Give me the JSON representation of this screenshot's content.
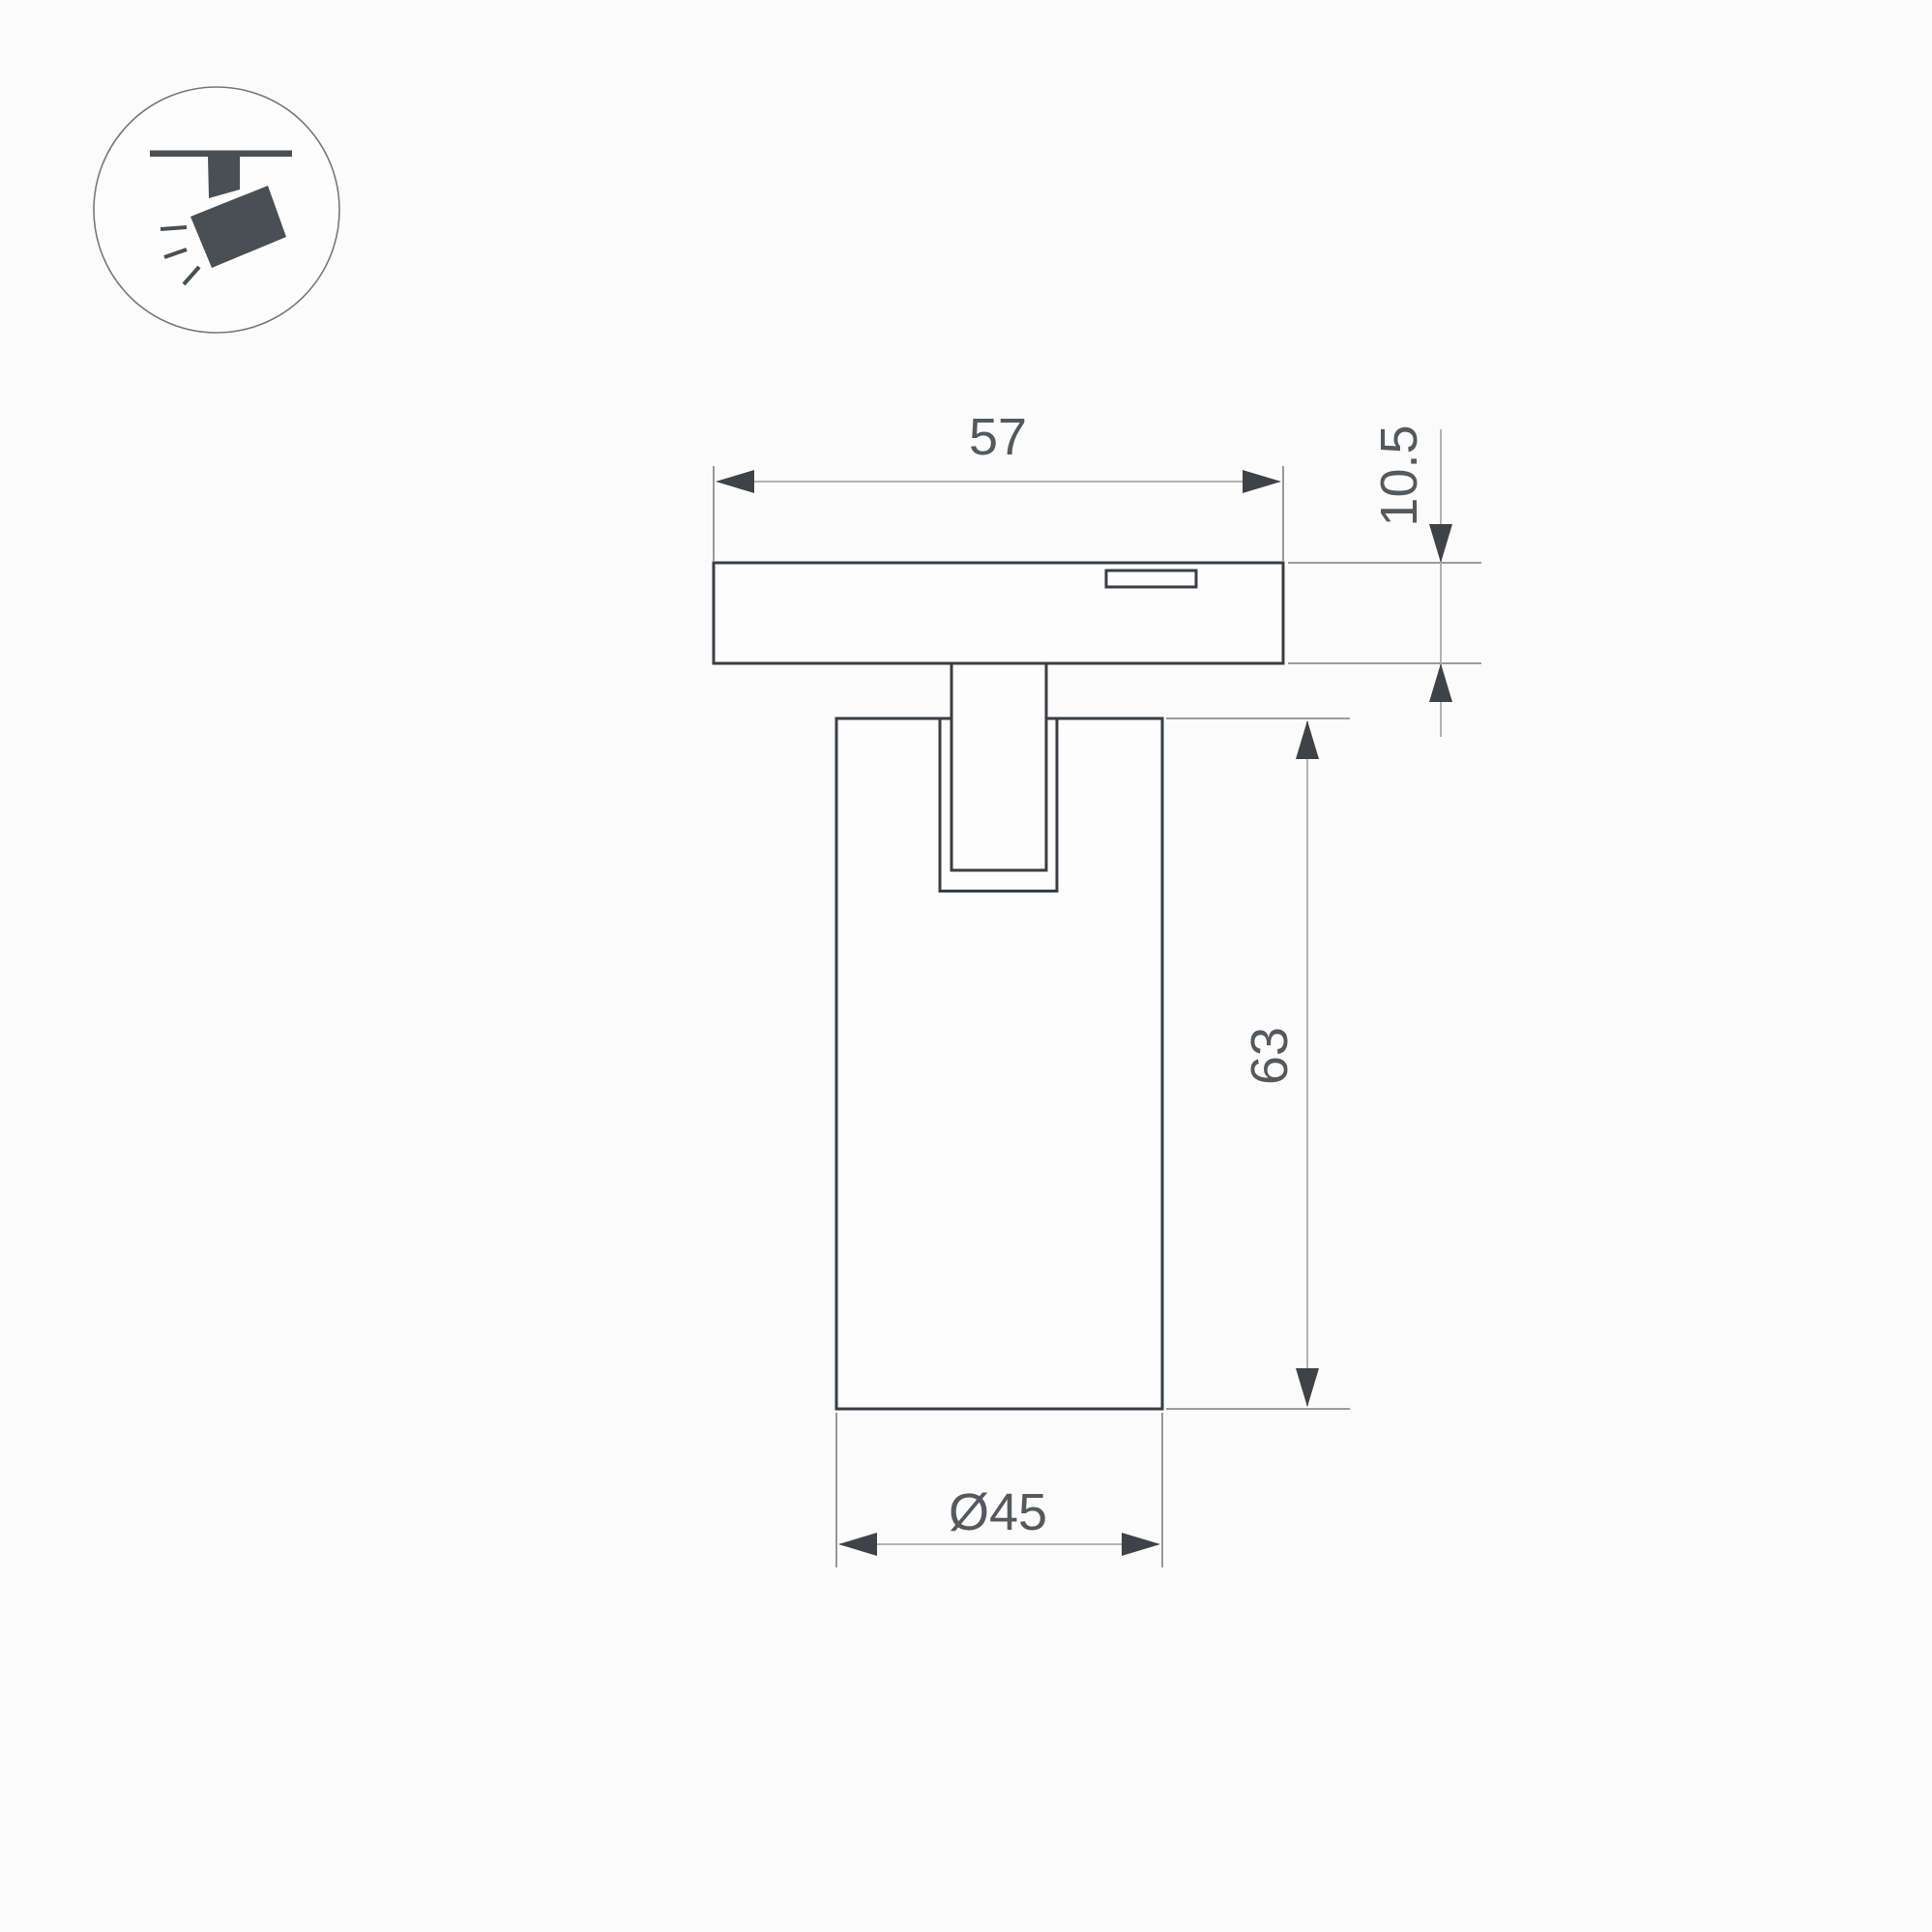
{
  "drawing": {
    "type": "technical-dimension-drawing",
    "subject": "magnetic track spotlight, side view",
    "labels": {
      "track_width": "57",
      "adapter_height": "10.5",
      "body_height": "63",
      "body_diameter": "Ø45"
    },
    "icon": {
      "name": "track-spotlight-pictogram",
      "description": "ceiling track rail with tilted spotlight head emitting light rays"
    },
    "colors": {
      "background": "#fbfbfb",
      "object_line": "#3a3e42",
      "extension_line": "#8b8e91",
      "dimension_line": "#b0b2b4",
      "arrow": "#3f4347",
      "text": "#55595d",
      "icon_fill": "#4a4f54"
    }
  }
}
